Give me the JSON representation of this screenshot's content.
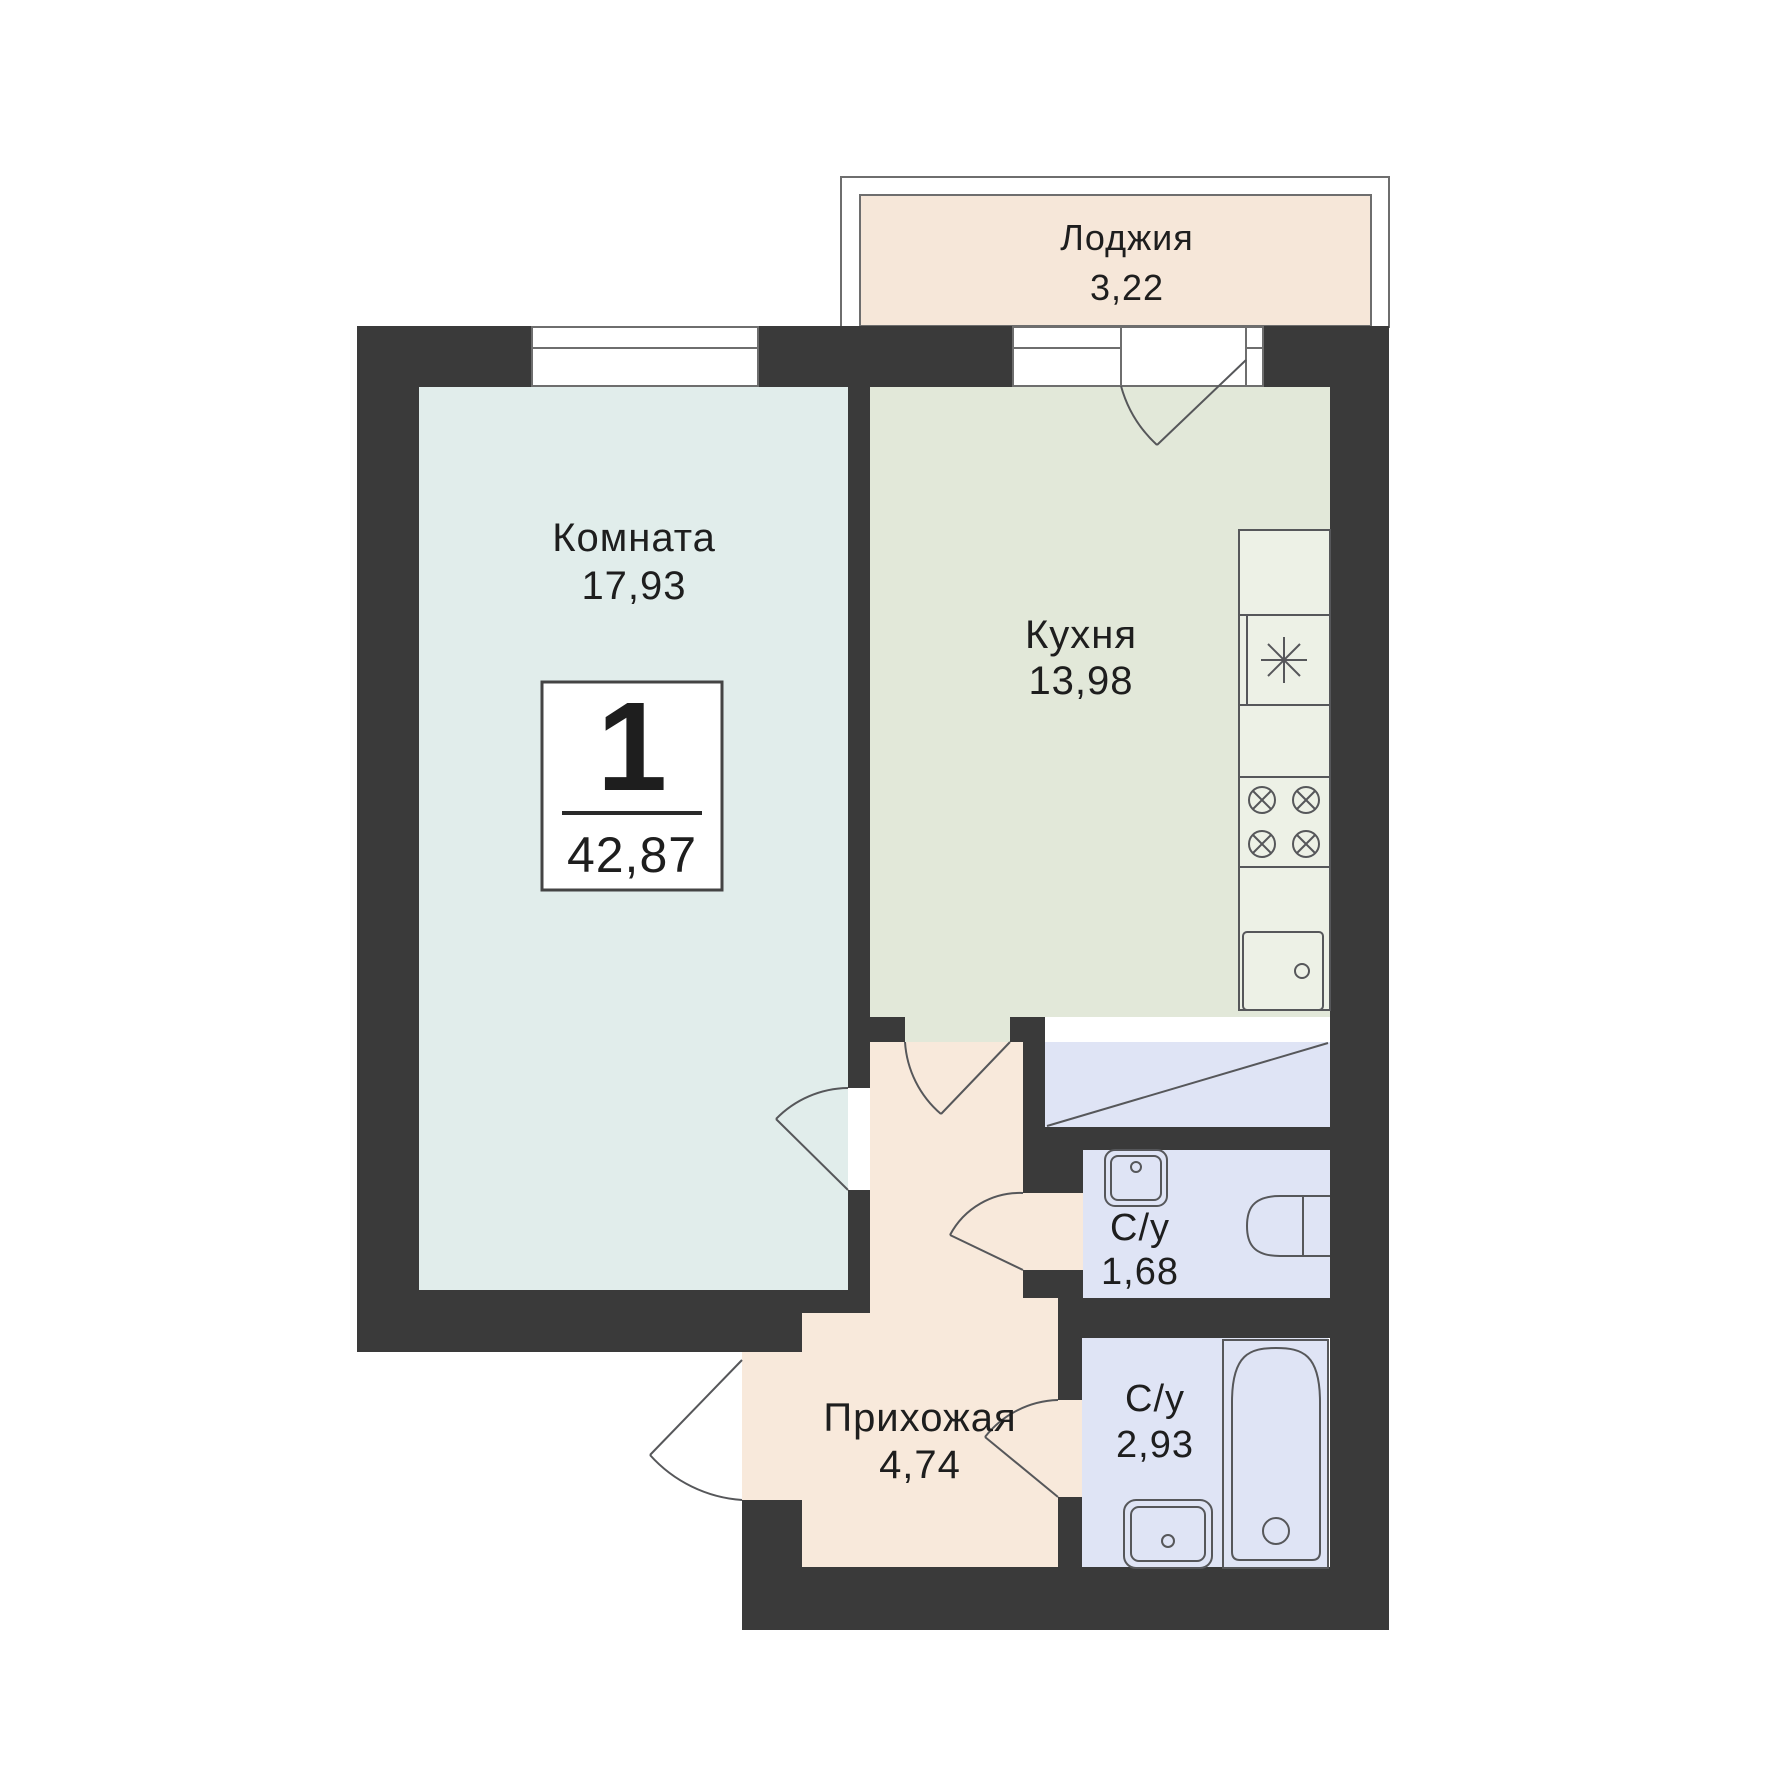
{
  "badge": {
    "number": "1",
    "total_area": "42,87"
  },
  "rooms": {
    "loggia": {
      "name": "Лоджия",
      "area": "3,22"
    },
    "living": {
      "name": "Комната",
      "area": "17,93"
    },
    "kitchen": {
      "name": "Кухня",
      "area": "13,98"
    },
    "hallway": {
      "name": "Прихожая",
      "area": "4,74"
    },
    "wc_small": {
      "name": "С/у",
      "area": "1,68"
    },
    "wc_large": {
      "name": "С/у",
      "area": "2,93"
    }
  },
  "fixtures": {
    "fridge": "fridge-icon",
    "stove": "stove-4-burners-icon",
    "kitchen_sink": "kitchen-sink-icon",
    "wash_basin_small": "wash-basin-icon",
    "toilet": "toilet-icon",
    "bathtub": "bathtub-icon",
    "wash_basin_large": "wash-basin-icon",
    "wardrobe": "wardrobe-crossed-icon"
  },
  "colors": {
    "wall": "#3a3a3a",
    "living_floor": "#e1edeb",
    "kitchen_floor": "#e2e8d9",
    "hallway_floor": "#f8e9db",
    "loggia_floor": "#f6e7d9",
    "bathroom_floor": "#dfe4f5",
    "counter": "#edf1e6",
    "outline": "#56575a",
    "text": "#1e1e1e"
  }
}
